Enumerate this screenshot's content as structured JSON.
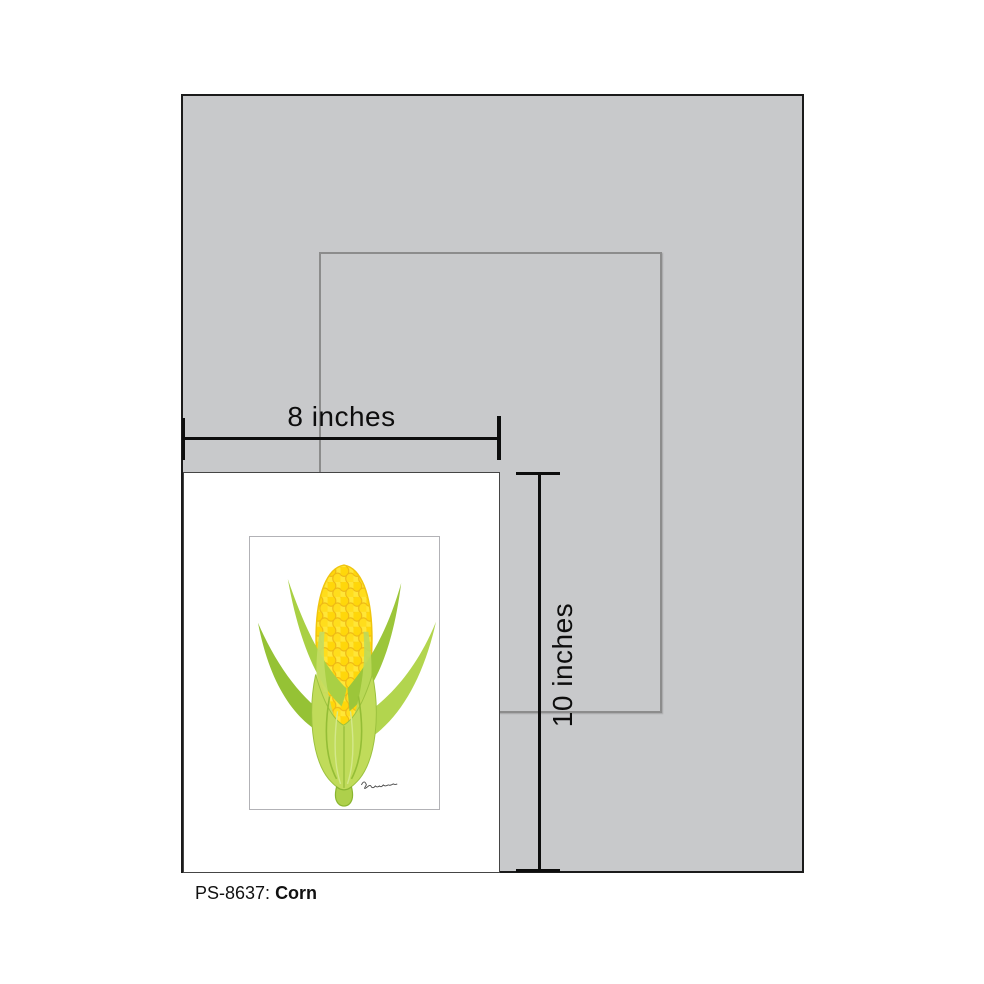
{
  "board": {
    "background_color": "#c8c9cb",
    "outline_color": "#8c8c8c"
  },
  "measurements": {
    "width_label": "8 inches",
    "height_label": "10 inches"
  },
  "caption": {
    "code": "PS-8637:",
    "title": "Corn"
  },
  "artwork": {
    "subject": "corn-botanical-illustration",
    "colors": {
      "kernel_yellow": "#ffd70a",
      "kernel_outline": "#edb615",
      "husk_green": "#c0db5a",
      "leaf_green": "#9cc63a"
    }
  }
}
